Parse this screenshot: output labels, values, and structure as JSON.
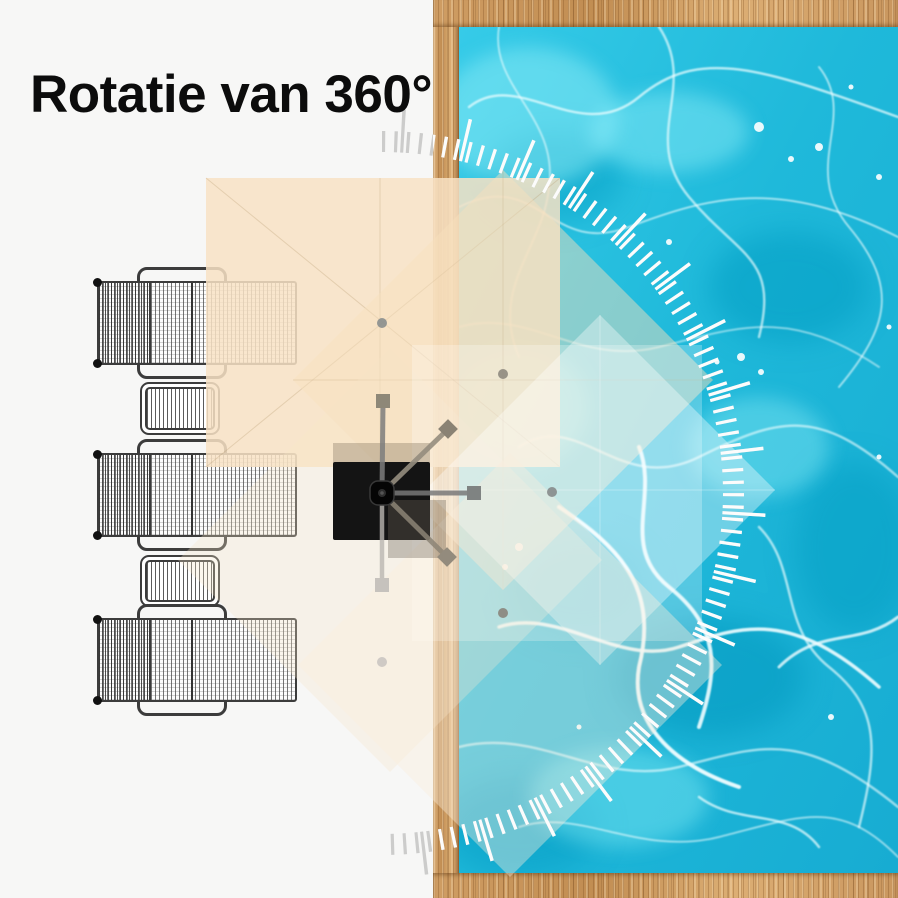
{
  "title": "Rotatie van 360°",
  "illustration": {
    "type": "top-view cantilever parasol 360-degree rotation diagram over pool deck",
    "rotation_label_deg": 360,
    "rotation_positions_deg": [
      0,
      45,
      90,
      135,
      180
    ],
    "furniture": {
      "sun_loungers": 3,
      "side_tables": 2
    },
    "colors": {
      "canopy_beige": "#f8e2c4",
      "pool_water": "#1fb9da",
      "wood_deck": "#cf9d63",
      "umbrella_base": "#141414",
      "tick_marks": "#ffffff",
      "line_art": "#3c3c3c"
    }
  }
}
